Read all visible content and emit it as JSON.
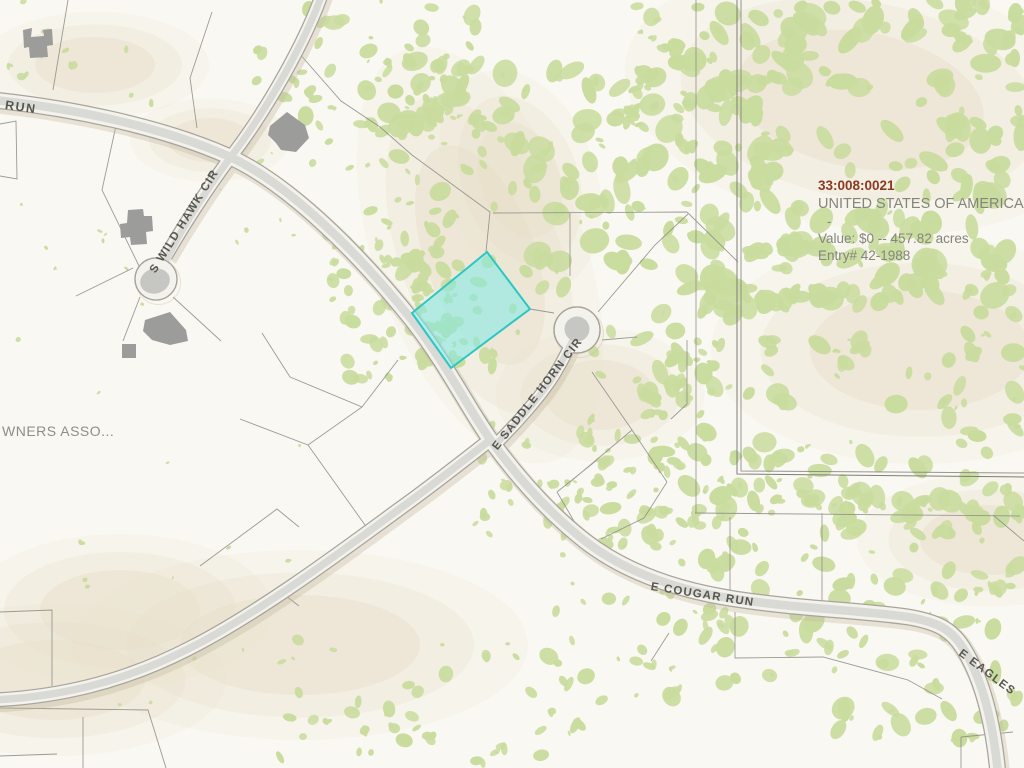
{
  "map": {
    "road_labels": {
      "run": "RUN",
      "s_wild_hawk_cir": "S WILD HAWK CIR",
      "e_saddle_horn_cir": "E SADDLE HORN CIR",
      "e_cougar_run": "E COUGAR RUN",
      "e_eagles": "E EAGLES"
    },
    "partial_label": "WNERS ASSO...",
    "parcel_info": {
      "parcel_id": "33:008:0021",
      "owner": "UNITED STATES OF AMERICA.",
      "dash": "-",
      "value_line": "Value: $0 -- 457.82 acres",
      "entry_line": "Entry# 42-1988"
    },
    "colors": {
      "background": "#faf8f2",
      "vegetation": "#c9dc9e",
      "tan_patch": "#e8dec8",
      "road_fill": "#f3f2ed",
      "road_center": "#d9d9d5",
      "road_casing": "#a8a49b",
      "road_shadow": "#c3b99f",
      "parcel_line": "#8b8b85",
      "big_parcel_line": "#7d7d78",
      "building": "#9c9c9a",
      "island": "#c6c6c2",
      "highlight_fill": "#7fe9e6",
      "highlight_stroke": "#2cc7c4",
      "parcel_id_color": "#8a3a22",
      "label_color": "#57574f",
      "info_text_color": "#85857c",
      "partial_label_color": "#8f8e86"
    }
  }
}
